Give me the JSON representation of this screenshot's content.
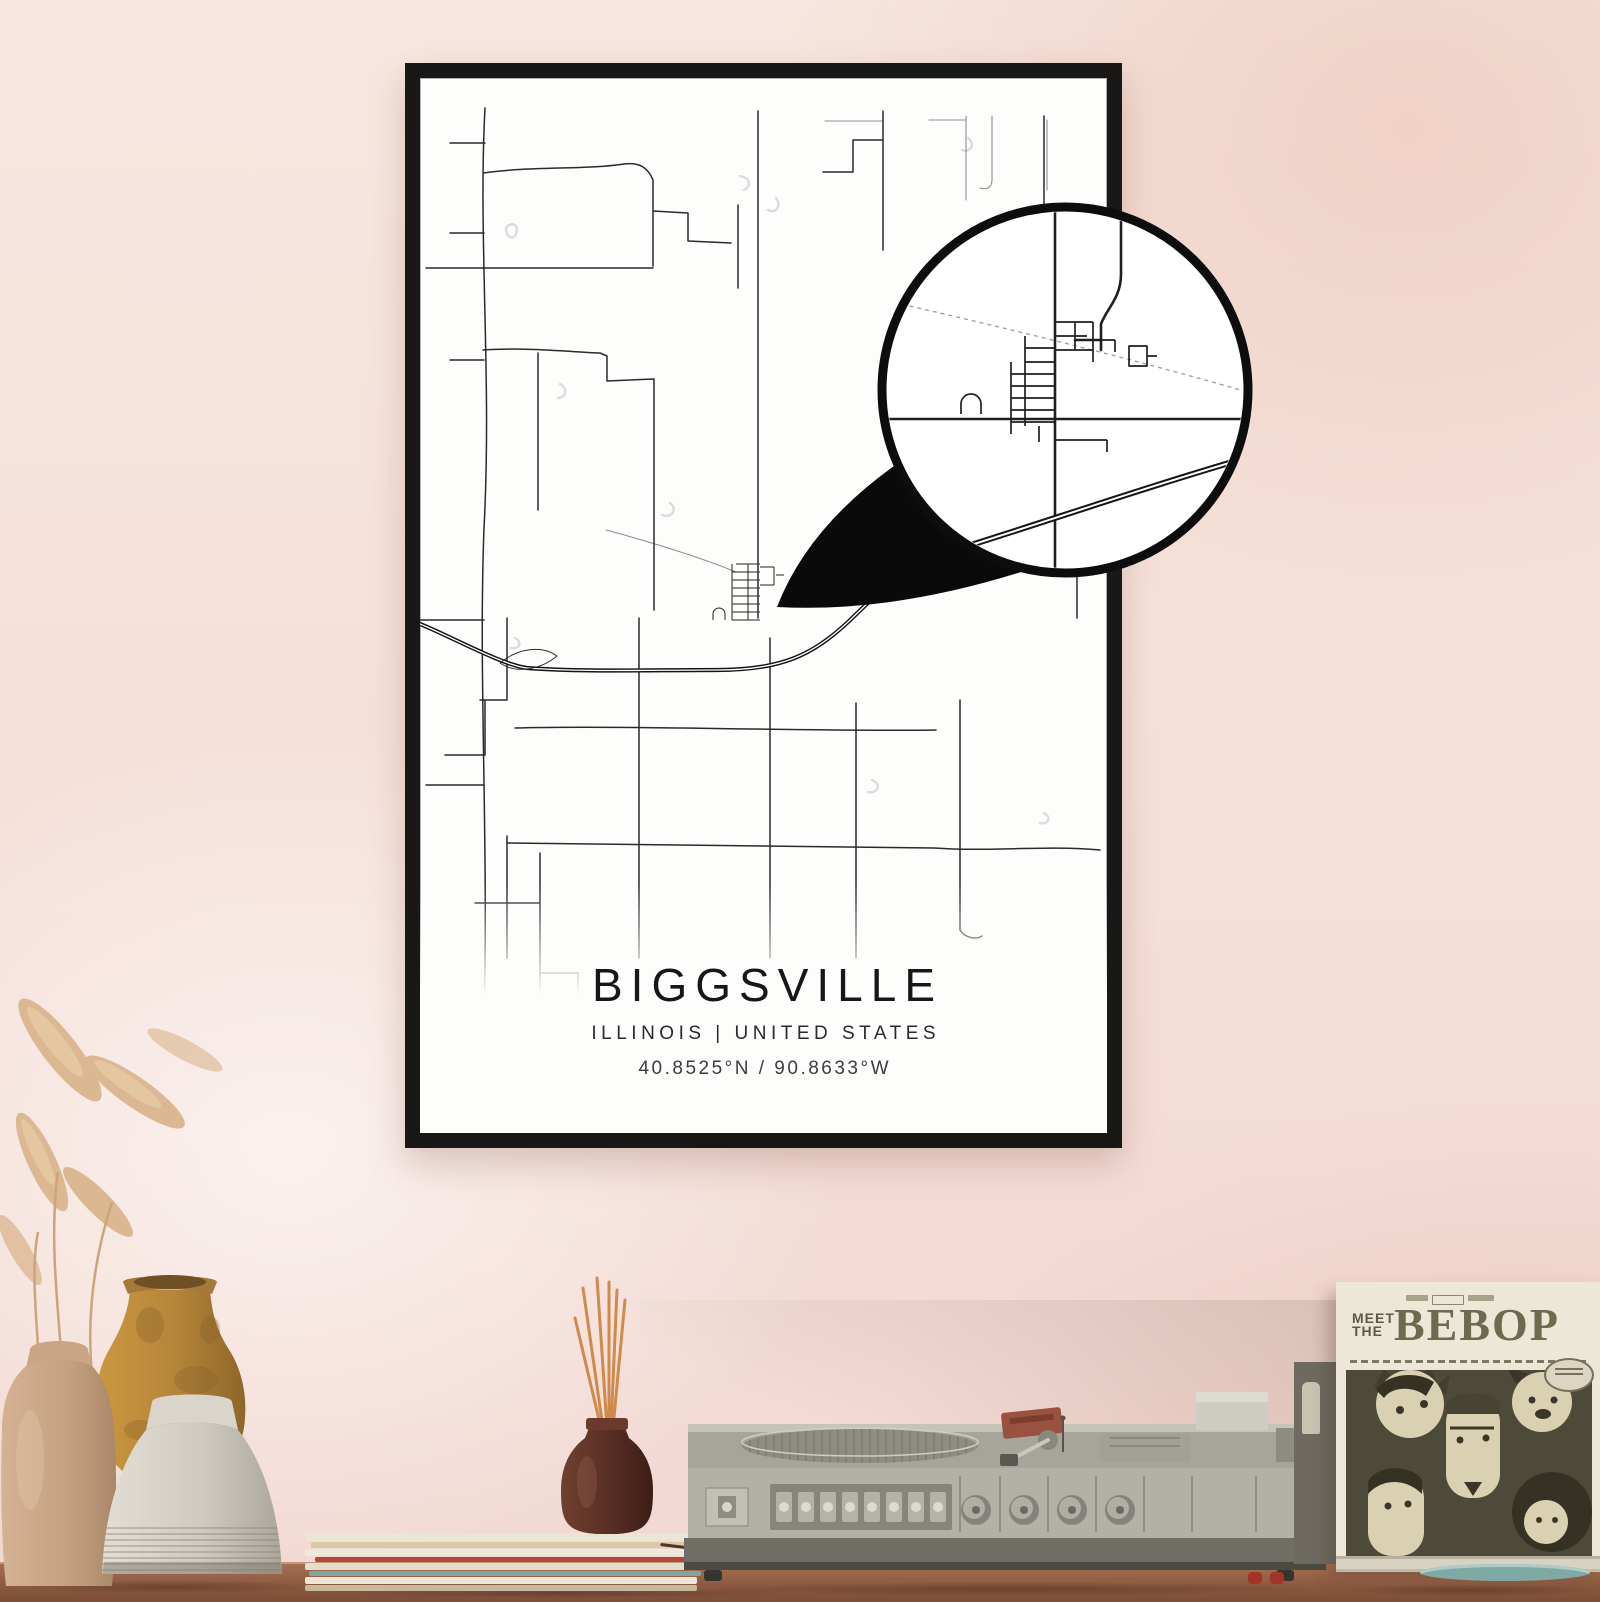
{
  "poster": {
    "title": "BIGGSVILLE",
    "subtitle": "ILLINOIS | UNITED STATES",
    "coordinates": "40.8525°N / 90.8633°W"
  },
  "record_sleeve": {
    "meet": "MEET",
    "the": "THE",
    "title": "BEBOP"
  },
  "colors": {
    "wall_pink": "#f5dfd8",
    "wall_pink_deep": "#e9c0b1",
    "frame_black": "#191816",
    "poster_white": "#fdfdfc",
    "map_road": "#2a2a2a",
    "map_road_light": "#909090",
    "map_creek": "#c9c9c9",
    "highway": "#141414",
    "magnifier_black": "#0a0a0a",
    "table_wood": "#8d5a41",
    "player_body": "#b3b1a7",
    "player_plinth": "#6f6d64",
    "sleeve_cream": "#ece7d6",
    "sleeve_art": "#4d4a39",
    "vase_tan": "#c9a584",
    "vase_amber": "#bb8a3e",
    "vase_white": "#d9d5cb",
    "diffuser_brown": "#5f3328",
    "incense_stick": "#cf8a4c",
    "teal_record": "#7fa9a5",
    "pampas": "#d9b48c"
  }
}
